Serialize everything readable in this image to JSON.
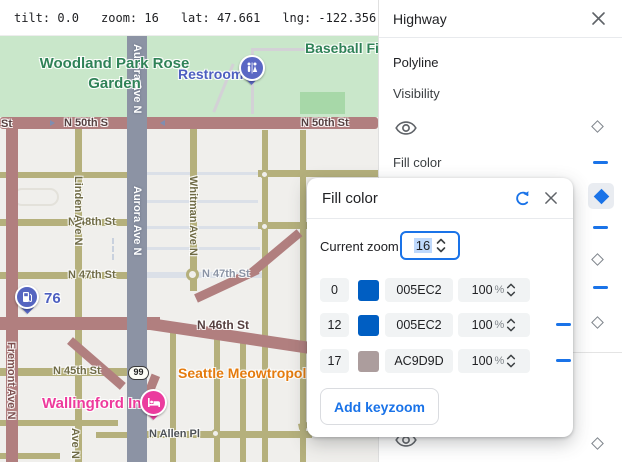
{
  "status_bar": {
    "items": [
      "tilt: 0.0",
      "zoom: 16",
      "lat: 47.661",
      "lng: -122.356"
    ]
  },
  "map": {
    "labels": {
      "park": "Woodland Park Rose Garden",
      "baseball": "Baseball Fi",
      "restroom": "Restroom",
      "gas": "76",
      "poi_cat": "Seattle Meowtropoli",
      "inn": "Wallingford Inn",
      "shield": "99",
      "st50_partial": "St",
      "st50_left": "N 50th S",
      "st50_right": "N 50th St",
      "st48": "N 48th St",
      "st47_w": "N 47th St",
      "st47_e": "N 47th St",
      "st46": "N 46th St",
      "st45": "N 45th St",
      "allen": "N Allen Pl",
      "aurora": "Aurora Ave N",
      "linden": "Linden Ave N",
      "whitman": "Whitman Ave N",
      "fremont": "Fremont Ave N",
      "ave_n_partial": "Ave N"
    },
    "colors": {
      "park": "#c9e7ca",
      "highway": "#b17f7f",
      "arterial": "#b5b07c",
      "aurora": "#8c93a4",
      "background": "#f0efec"
    }
  },
  "panel": {
    "title": "Highway",
    "section_polyline": "Polyline",
    "visibility_label": "Visibility",
    "fill_color_label": "Fill color"
  },
  "dialog": {
    "title": "Fill color",
    "current_zoom_label": "Current zoom",
    "current_zoom_value": "16",
    "rows": [
      {
        "zoom": "0",
        "hex": "005EC2",
        "swatch_style": "background:#005EC2",
        "opacity": "100",
        "pct": "%"
      },
      {
        "zoom": "12",
        "hex": "005EC2",
        "swatch_style": "background:#005EC2",
        "opacity": "100",
        "pct": "%"
      },
      {
        "zoom": "17",
        "hex": "AC9D9D",
        "swatch_style": "background:#AC9D9D",
        "opacity": "100",
        "pct": "%"
      }
    ],
    "add_button_label": "Add keyzoom"
  },
  "colors": {
    "accent": "#1a73e8",
    "swatch_blue": "#005EC2",
    "swatch_mauve": "#AC9D9D"
  }
}
